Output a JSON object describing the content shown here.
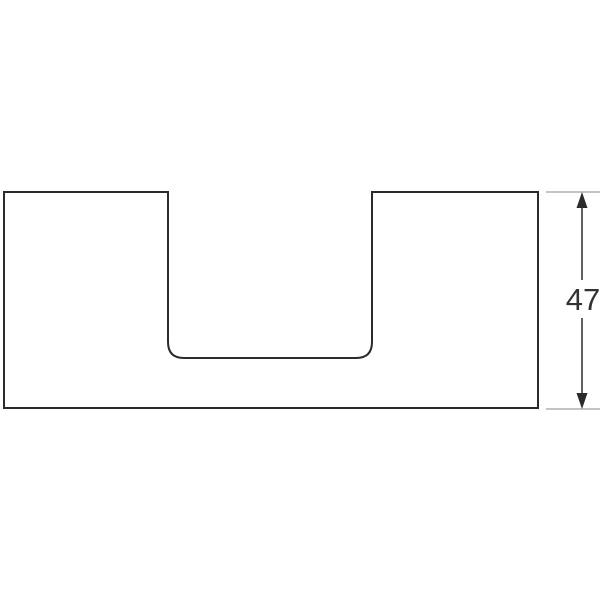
{
  "drawing": {
    "kind": "technical-dimension-drawing",
    "dimension": {
      "value": "47",
      "orientation": "vertical"
    },
    "colors": {
      "outline": "#2b2b2b",
      "extension_line": "#b0b0b0",
      "text": "#333333",
      "background": "#ffffff"
    }
  }
}
